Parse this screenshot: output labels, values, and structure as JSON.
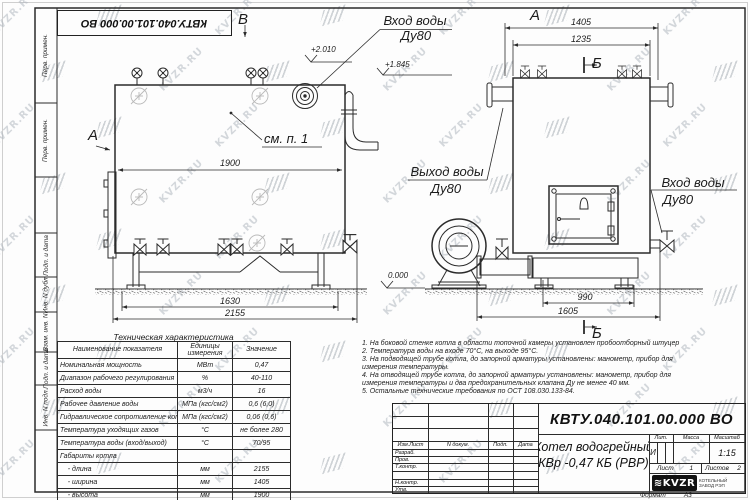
{
  "colors": {
    "line": "#2b2b2b",
    "watermark": "#b2b9c1",
    "logo_bg": "#111111"
  },
  "watermark_text": "KVZR.RU",
  "frame": {
    "stamp_top": "КВТУ.040.101.00.000  ВО",
    "format_label": "Формат",
    "format_value": "А3"
  },
  "margin_labels": [
    "Перв. примен.",
    "Перв. примен.",
    "Подп. и дата",
    "Инв. N дубл.",
    "Взам. инв. N",
    "Подп. и дата",
    "Инв. N подл."
  ],
  "labels": {
    "view_b": "В",
    "view_a_left": "А",
    "view_a_right": "А",
    "section_b_top": "Б",
    "section_b_bottom": "Б",
    "inlet_top_line1": "Вход воды",
    "inlet_top_line2": "Ду80",
    "outlet_line1": "Выход воды",
    "outlet_line2": "Ду80",
    "inlet_right_line1": "Вход воды",
    "inlet_right_line2": "Ду80",
    "see_item": "см. п. 1",
    "elev_plus2010": "+2.010",
    "elev_plus1845": "+1.845",
    "elev_zero": "0.000"
  },
  "dims": {
    "front_width": "1900",
    "front_base": "1630",
    "front_total": "2155",
    "side_top": "1405",
    "side_inner": "1235",
    "side_base": "990",
    "side_total": "1605"
  },
  "tech_table": {
    "title": "Техническая характеристика",
    "headers": [
      "Наименование показателя",
      "Единицы измерения",
      "Значение"
    ],
    "rows": [
      [
        "Номинальная мощность",
        "МВт",
        "0,47"
      ],
      [
        "Диапазон рабочего регулирования",
        "%",
        "40-110"
      ],
      [
        "Расход воды",
        "м3/ч",
        "16"
      ],
      [
        "Рабочее давление воды",
        "МПа (кгс/см2)",
        "0,6 (6,0)"
      ],
      [
        "Гидравлическое сопротивление котла",
        "МПа (кгс/см2)",
        "0,06 (0,6)"
      ],
      [
        "Температура уходящих газов",
        "°С",
        "не более 280"
      ],
      [
        "Температура воды (вход/выход)",
        "°С",
        "70/95"
      ],
      [
        "Габариты котла",
        "",
        ""
      ],
      [
        "    - длина",
        "мм",
        "2155"
      ],
      [
        "    - ширина",
        "мм",
        "1405"
      ],
      [
        "    - высота",
        "мм",
        "1900"
      ]
    ]
  },
  "notes": [
    "1. На боковой стенке котла в области топочной камеры установлен пробоотборный штуцер",
    "2. Температура воды на входе  70°С,  на выходе  95°С.",
    "3. На подводящей трубе котла, до запорной арматуры установлены:  манометр,  прибор для измерения температуры.",
    "4. На отводящей трубе котла, до запорной арматуры установлены:  манометр,  прибор для измерения температуры и два предохранительных клапана  Ду не менее  40 мм.",
    "5. Остальные технические требования по ОСТ  108.030.133-84."
  ],
  "title_block": {
    "doc_number": "КВТУ.040.101.00.000  ВО",
    "name_line1": "Котел водогрейный",
    "name_line2": "КВр -0,47  КБ  (РВР)",
    "col_izm": "Изм.Лист",
    "col_doc": "N докум.",
    "col_sign": "Подп.",
    "col_date": "Дата",
    "rows": [
      "Разраб.",
      "Пров.",
      "Т.контр.",
      "",
      "Н.контр.",
      "Утв."
    ],
    "lit_label": "Лит.",
    "lit_value": "И",
    "mass_label": "Масса",
    "scale_label": "Масштаб",
    "scale_value": "1:15",
    "sheet_label": "Лист",
    "sheet_value": "1",
    "sheets_label": "Листов",
    "sheets_value": "2",
    "logo_text": "≋KVZR",
    "company_line1": "КОТЕЛЬНЫЙ",
    "company_line2": "ЗАВОД РЭП"
  }
}
